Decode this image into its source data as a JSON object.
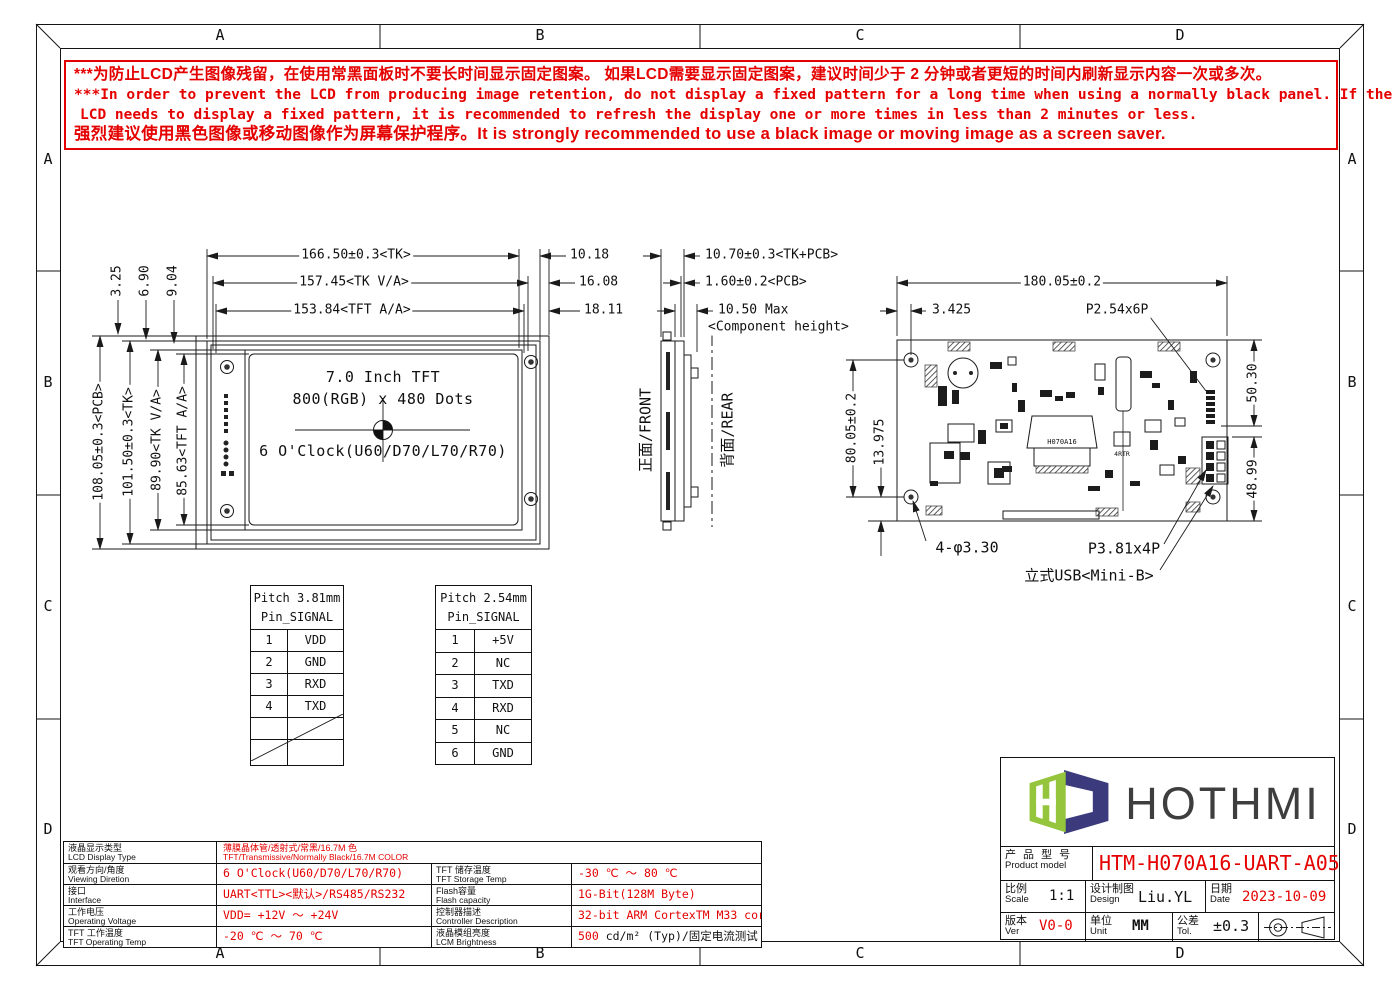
{
  "colors": {
    "red": "#e50000",
    "line": "#1a1a1a",
    "logo_green": "#95c53d",
    "logo_navy": "#3a3a7c"
  },
  "sheet": {
    "cols": [
      "A",
      "B",
      "C",
      "D"
    ],
    "rows": [
      "A",
      "B",
      "C",
      "D"
    ]
  },
  "warning": {
    "line1": "***为防止LCD产生图像残留，在使用常黑面板时不要长时间显示固定图案。 如果LCD需要显示固定图案，建议时间少于 2 分钟或者更短的时间内刷新显示内容一次或多次。",
    "line2": "***In order to prevent the LCD from producing image retention, do not display a fixed pattern for a long time when using a normally black panel. If the",
    "line3": "LCD needs to display a fixed pattern,  it is recommended to refresh the display one or more times in less than 2 minutes or less.",
    "line4": "强烈建议使用黑色图像或移动图像作为屏幕保护程序。It is strongly recommended to use a black image or moving image as a screen saver."
  },
  "front_view": {
    "dim_tk_w": "166.50±0.3<TK>",
    "dim_va_w": "157.45<TK V/A>",
    "dim_aa_w": "153.84<TFT A/A>",
    "off1": "10.18",
    "off2": "16.08",
    "off3": "18.11",
    "off_l1": "3.25",
    "off_l2": "6.90",
    "off_l3": "9.04",
    "dim_pcb_h": "108.05±0.3<PCB>",
    "dim_tk_h": "101.50±0.3<TK>",
    "dim_va_h": "89.90<TK V/A>",
    "dim_aa_h": "85.63<TFT A/A>",
    "screen1": "7.0 Inch TFT",
    "screen2": "800(RGB) x 480 Dots",
    "screen3": "6 O'Clock(U60/D70/L70/R70)"
  },
  "side_view": {
    "dim1": "10.70±0.3<TK+PCB>",
    "dim2": "1.60±0.2<PCB>",
    "dim3": "10.50 Max",
    "dim3b": "<Component height>",
    "front": "正面/FRONT",
    "rear": "背面/REAR"
  },
  "rear_view": {
    "dim_w": "180.05±0.2",
    "dim_off": "3.425",
    "conn_top": "P2.54x6P",
    "dim_hv": "80.05±0.2",
    "dim_bo": "13.975",
    "dim_r1": "50.30",
    "dim_r2": "48.99",
    "holes": "4-φ3.30",
    "conn_right": "P3.81x4P",
    "usb": "立式USB<Mini-B>",
    "chip": "H070A16",
    "rtr": "4RTR"
  },
  "pin_table_1": {
    "title": "Pitch 3.81mm",
    "header": "Pin_SIGNAL",
    "rows": [
      [
        "1",
        "VDD"
      ],
      [
        "2",
        "GND"
      ],
      [
        "3",
        "RXD"
      ],
      [
        "4",
        "TXD"
      ]
    ]
  },
  "pin_table_2": {
    "title": "Pitch 2.54mm",
    "header": "Pin_SIGNAL",
    "rows": [
      [
        "1",
        "+5V"
      ],
      [
        "2",
        "NC"
      ],
      [
        "3",
        "TXD"
      ],
      [
        "4",
        "RXD"
      ],
      [
        "5",
        "NC"
      ],
      [
        "6",
        "GND"
      ]
    ]
  },
  "spec_table": {
    "rows": [
      {
        "label_cn": "液晶显示类型",
        "label_en": "LCD Display Type",
        "value_line1": "薄膜晶体管/透射式/常黑/16.7M 色",
        "value_line2": "TFT/Transmissive/Normally Black/16.7M COLOR"
      },
      {
        "label_cn": "观看方向/角度",
        "label_en": "Viewing Diretion",
        "value": "6 O'Clock(U60/D70/L70/R70)",
        "label2_cn": "TFT 储存温度",
        "label2_en": "TFT Storage Temp",
        "value2": "-30 ℃ ～ 80 ℃"
      },
      {
        "label_cn": "接口",
        "label_en": "Interface",
        "value": "UART<TTL><默认>/RS485/RS232",
        "label2_cn": "Flash容量",
        "label2_en": "Flash capacity",
        "value2": "1G-Bit(128M Byte)"
      },
      {
        "label_cn": "工作电压",
        "label_en": "Operating Voltage",
        "value": "VDD= +12V ～ +24V",
        "label2_cn": "控制器描述",
        "label2_en": "Controller Description",
        "value2": "32-bit ARM CortexTM M33 core"
      },
      {
        "label_cn": "TFT 工作温度",
        "label_en": "TFT Operating Temp",
        "value": "-20 ℃ ～ 70 ℃",
        "label2_cn": "液晶模组亮度",
        "label2_en": "LCM Brightness",
        "value2_red": "500",
        "value2_rest": " cd/m² (Typ)/固定电流测试"
      }
    ]
  },
  "title_block": {
    "brand": "HOTHMI",
    "product_label_cn": "产 品 型 号",
    "product_label_en": "Product model",
    "product_model": "HTM-H070A16-UART-A05",
    "scale_cn": "比例",
    "scale_en": "Scale",
    "scale_value": "1:1",
    "design_cn": "设计制图",
    "design_en": "Design",
    "design_value": "Liu.YL",
    "date_cn": "日期",
    "date_en": "Date",
    "date_value": "2023-10-09",
    "ver_cn": "版本",
    "ver_en": "Ver",
    "ver_value": "V0-0",
    "unit_cn": "单位",
    "unit_en": "Unit",
    "unit_value": "MM",
    "tol_cn": "公差",
    "tol_en": "Tol.",
    "tol_value": "±0.3"
  }
}
